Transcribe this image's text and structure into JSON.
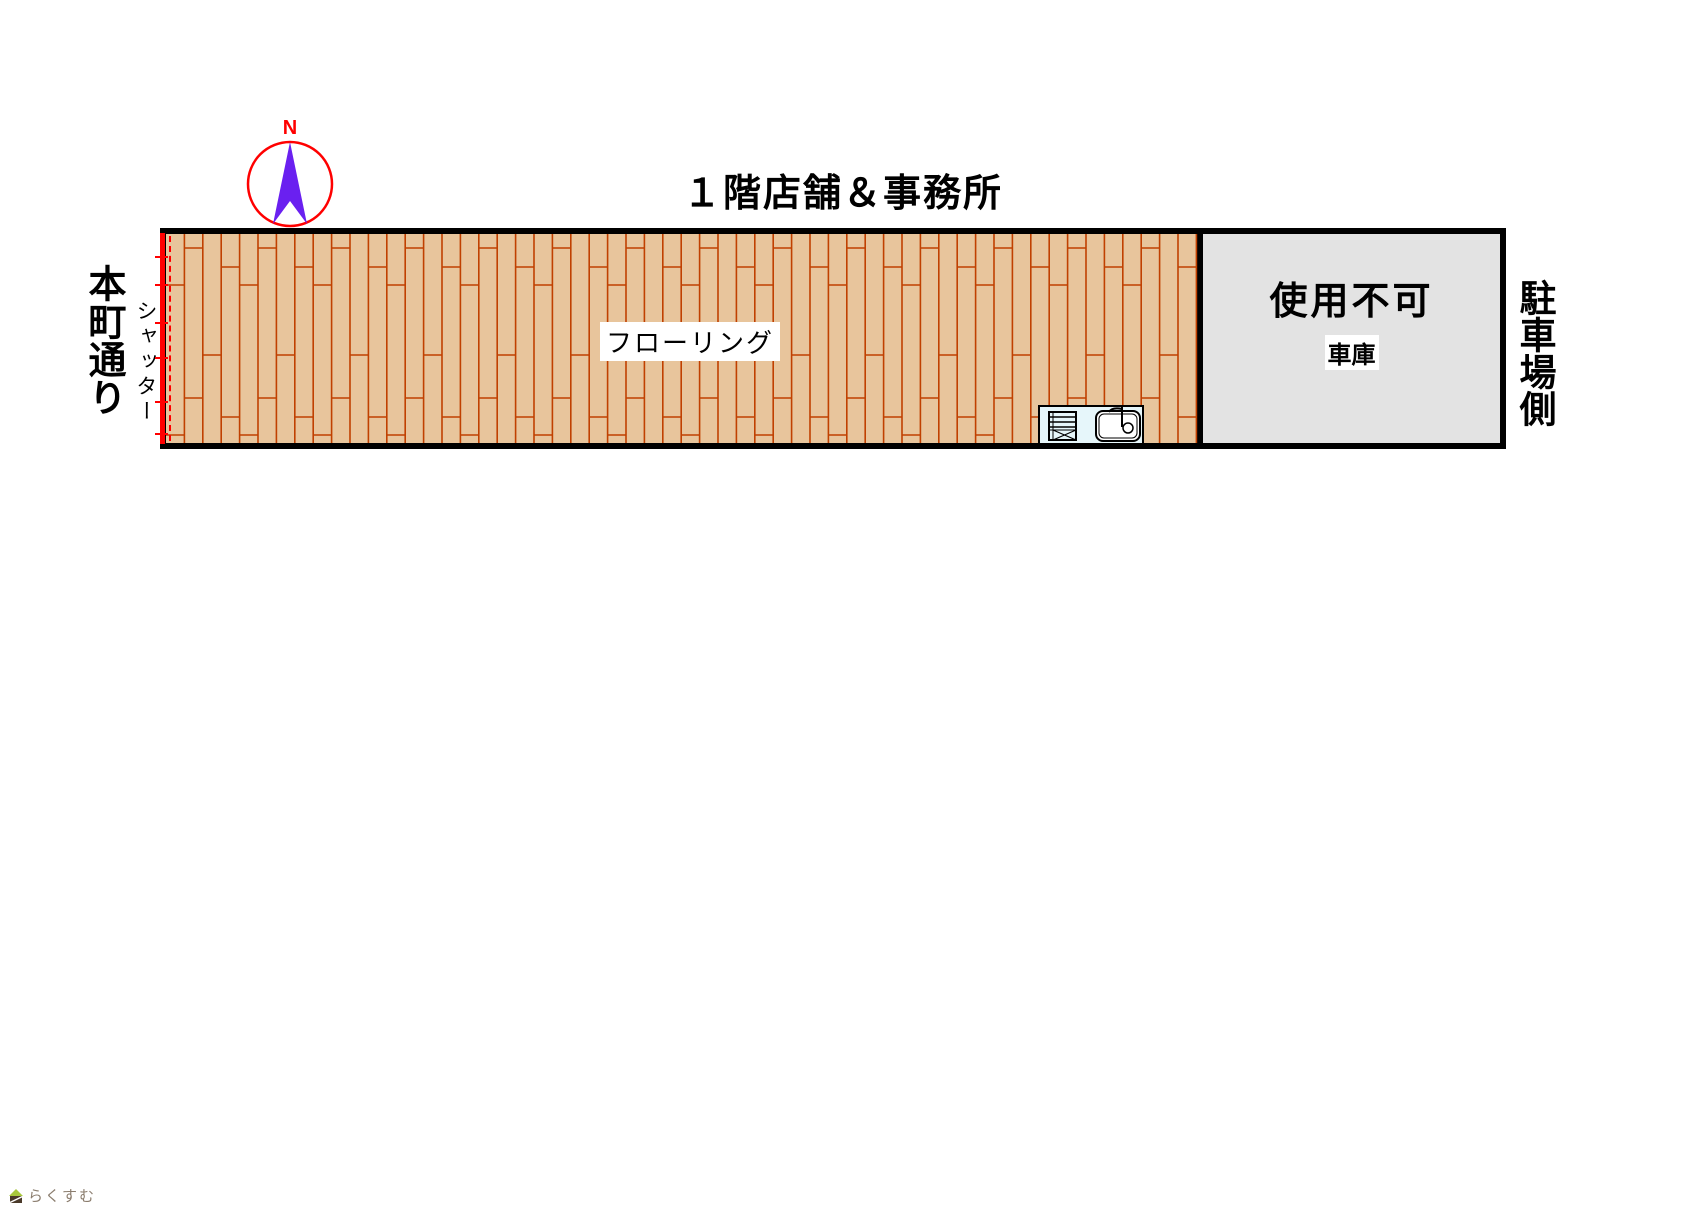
{
  "title": "１階店舗＆事務所",
  "compass": {
    "north_label": "N",
    "icon": "north-arrow-icon"
  },
  "labels": {
    "street": "本町通り",
    "shutter": "シャッター",
    "flooring": "フローリング",
    "parking_side": "駐車場側"
  },
  "garage": {
    "status": "使用不可",
    "name": "車庫"
  },
  "fixtures": {
    "kitchen": "kitchen-sink-icon"
  },
  "watermark": {
    "text": "らくすむ",
    "icon": "house-logo-icon"
  },
  "colors": {
    "floor_fill": "#e8c59c",
    "floor_line": "#c04000",
    "shutter_red": "#ff0000",
    "garage_fill": "#e3e3e3",
    "wall_black": "#000000",
    "compass_arrow": "#6a20f0",
    "compass_ring": "#ff0000",
    "sink_fill": "#e6f6fa",
    "watermark_text": "#8b7d6e",
    "watermark_leaf": "#a8c83c",
    "watermark_house": "#4a3a2a"
  },
  "pattern": {
    "plank_width": 18.4,
    "plank_length": 150,
    "joint_offsets": [
      51,
      14,
      121,
      33
    ],
    "tick_positions": [
      22,
      50,
      88,
      123,
      167,
      199
    ]
  }
}
